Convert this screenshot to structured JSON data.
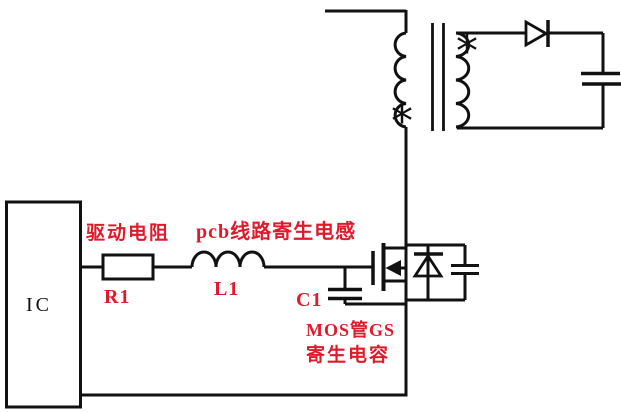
{
  "diagram": {
    "labels": {
      "ic": "IC",
      "drive_resistor_caption": "驱动电阻",
      "resistor_ref": "R1",
      "pcb_inductance_caption": "pcb线路寄生电感",
      "inductor_ref": "L1",
      "capacitor_ref": "C1",
      "mos_gs_caption_line1": "MOS管GS",
      "mos_gs_caption_line2": "寄生电容",
      "primary_polarity_mark": "*",
      "secondary_polarity_mark": "*"
    },
    "colors": {
      "line": "#111111",
      "label_red": "#e11a2b",
      "background": "#ffffff"
    }
  }
}
